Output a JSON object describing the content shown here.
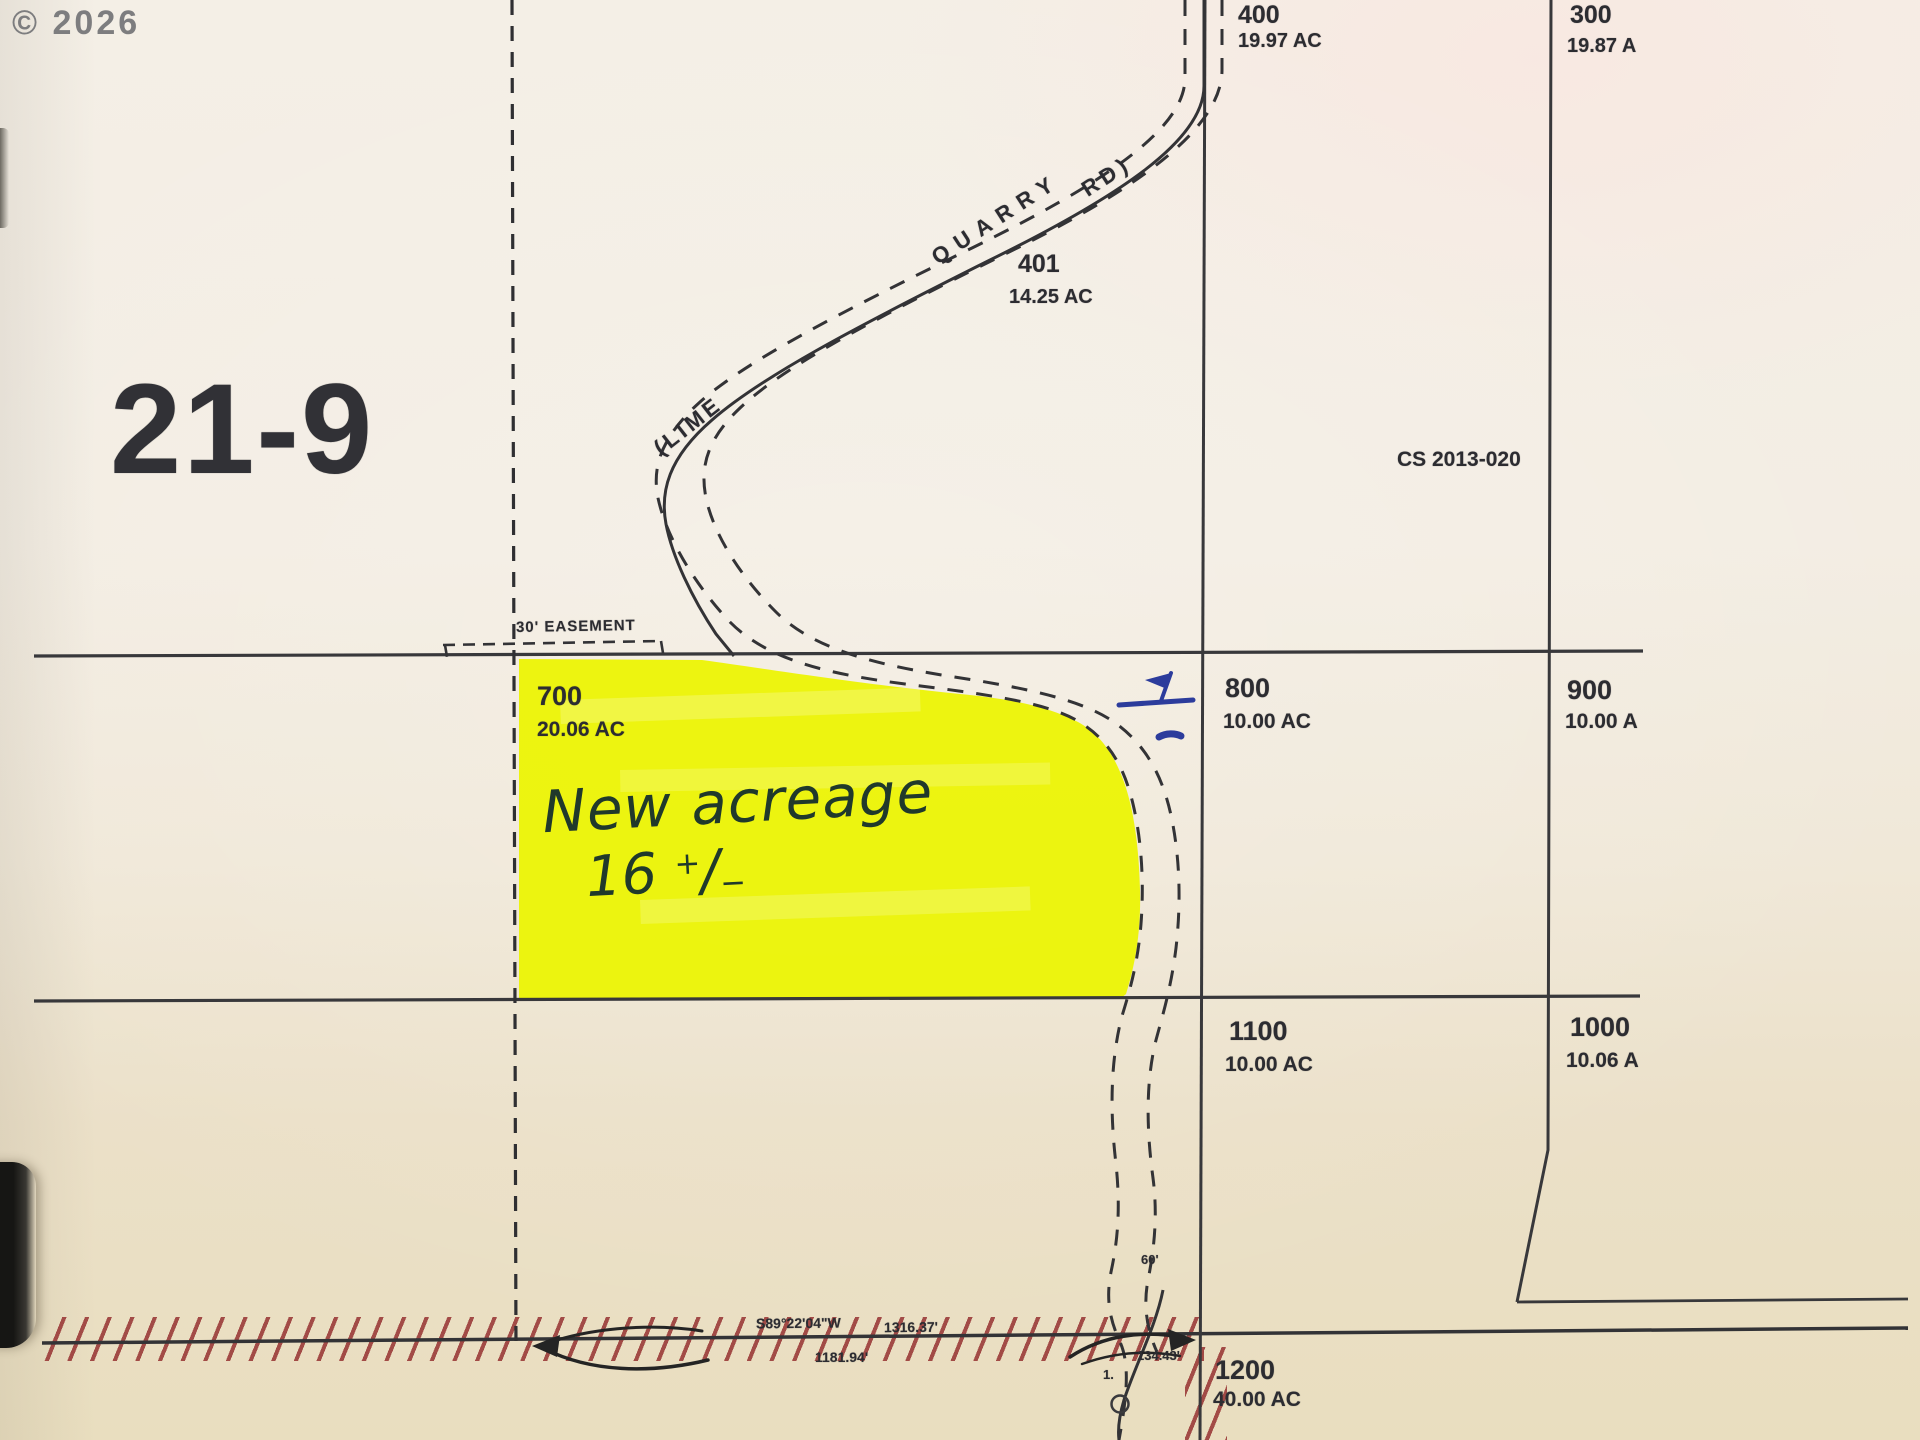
{
  "watermark": "© 2026",
  "map": {
    "sheet_code": "21-9",
    "survey_ref": "CS 2013-020",
    "easement_label": "30' EASEMENT",
    "road_name": {
      "part1": "(LIME",
      "part2": "QUARRY",
      "part3": "RD)"
    }
  },
  "parcels": {
    "p400": {
      "id": "400",
      "area": "19.97 AC"
    },
    "p300": {
      "id": "300",
      "area": "19.87 A"
    },
    "p401": {
      "id": "401",
      "area": "14.25 AC"
    },
    "p700": {
      "id": "700",
      "area": "20.06 AC"
    },
    "p800": {
      "id": "800",
      "area": "10.00 AC"
    },
    "p900": {
      "id": "900",
      "area": "10.00 A"
    },
    "p1100": {
      "id": "1100",
      "area": "10.00 AC"
    },
    "p1000": {
      "id": "1000",
      "area": "10.06 A"
    },
    "p1200": {
      "id": "1200",
      "area": "40.00 AC"
    }
  },
  "survey": {
    "bearing": "S89°22'04\"W",
    "distance_total": "1316.37'",
    "distance_left": "1181.94'",
    "distance_right": "134.43'",
    "road_width": "60'",
    "point_label": "1."
  },
  "annotations": {
    "handwritten_line1": "New acreage",
    "handwritten_value": "16",
    "tol_plus": "+",
    "tol_slash": "/",
    "tol_minus": "−"
  },
  "colors": {
    "highlight": "#ecf400",
    "hatch": "#963131",
    "pen_blue": "#2c3c9c",
    "map_line": "#38383b",
    "paper": "#f3eee3"
  }
}
